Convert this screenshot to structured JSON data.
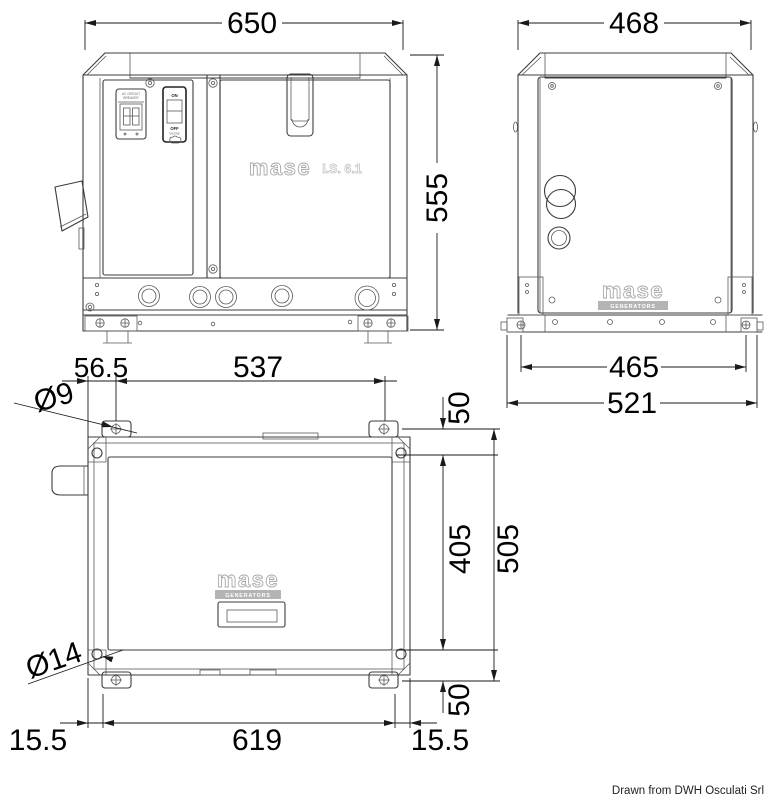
{
  "drawing": {
    "credit": "Drawn from DWH Osculati Srl",
    "brand": {
      "name": "mase",
      "model": "I.S. 6.1",
      "sub": "GENERATORS"
    },
    "controls": {
      "breaker_line1": "AC CIRCUIT",
      "breaker_line2": "BREAKER",
      "on": "ON",
      "off": "OFF",
      "engine": "ENGINE"
    },
    "dims": {
      "front_width": "650",
      "front_height": "555",
      "side_width": "468",
      "side_holes_span": "465",
      "side_overall_span": "521",
      "plan_hole_offset": "56.5",
      "plan_holes_span_x": "537",
      "plan_top_inset": "50",
      "plan_cover_depth": "405",
      "plan_holes_span_y": "505",
      "plan_bottom_inset": "50",
      "plan_margin_left": "15.5",
      "plan_base_span": "619",
      "plan_margin_right": "15.5",
      "mount_hole_dia": "Ø9",
      "frame_hole_dia": "Ø14"
    }
  }
}
